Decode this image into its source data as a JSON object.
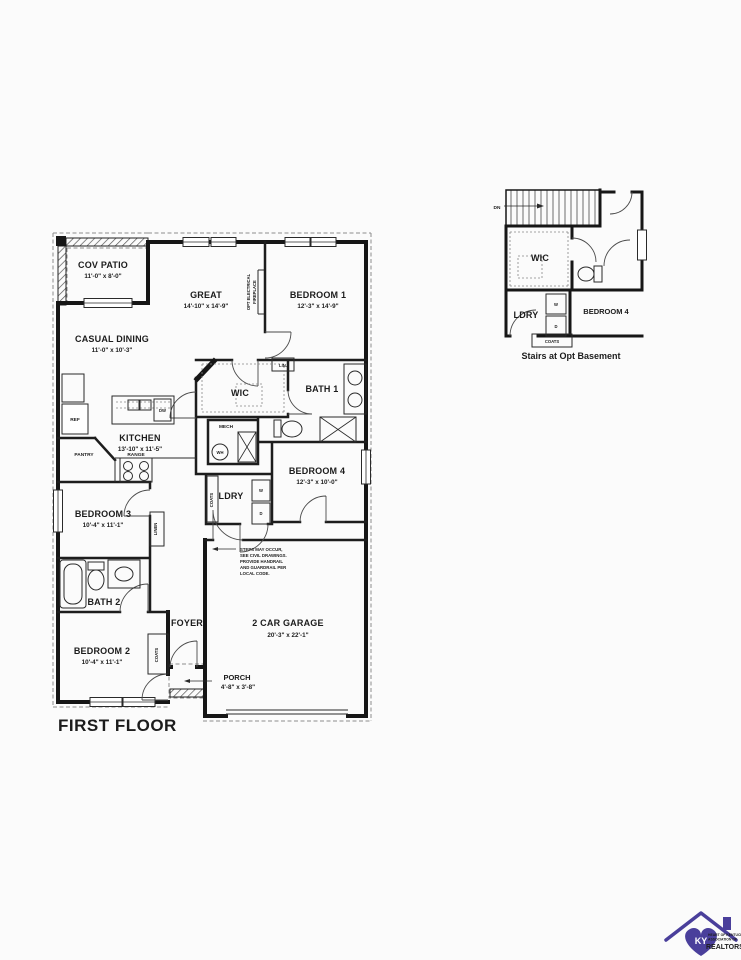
{
  "title": "FIRST FLOOR",
  "rooms": {
    "cov_patio": {
      "name": "COV PATIO",
      "dims": "11'-0\" x 8'-0\""
    },
    "casual_dining": {
      "name": "CASUAL DINING",
      "dims": "11'-0\" x 10'-3\""
    },
    "great": {
      "name": "GREAT",
      "dims": "14'-10\" x 14'-9\""
    },
    "bedroom1": {
      "name": "BEDROOM 1",
      "dims": "12'-3\" x 14'-9\""
    },
    "wic": {
      "name": "WIC"
    },
    "bath1": {
      "name": "BATH 1"
    },
    "kitchen": {
      "name": "KITCHEN",
      "dims": "13'-10\" x 11'-5\""
    },
    "bedroom4": {
      "name": "BEDROOM 4",
      "dims": "12'-3\" x 10'-0\""
    },
    "bedroom3": {
      "name": "BEDROOM 3",
      "dims": "10'-4\" x 11'-1\""
    },
    "ldry": {
      "name": "LDRY"
    },
    "bath2": {
      "name": "BATH 2"
    },
    "foyer": {
      "name": "FOYER"
    },
    "garage": {
      "name": "2 CAR GARAGE",
      "dims": "20'-3\" x 22'-1\""
    },
    "bedroom2": {
      "name": "BEDROOM 2",
      "dims": "10'-4\" x 11'-1\""
    },
    "porch": {
      "name": "PORCH",
      "dims": "4'-8\" x 3'-8\""
    }
  },
  "fixtures": {
    "ref": "REF",
    "pantry": "PANTRY",
    "range": "RANGE",
    "dw": "DW",
    "mech": "MECH",
    "wh": "WH",
    "lin": "LIN.",
    "linen": "LINEN",
    "coats": "COATS",
    "washer": "W",
    "dryer": "D"
  },
  "annotations": {
    "fireplace_line1": "OPT ELECTRICAL",
    "fireplace_line2": "FIREPLACE",
    "steps_note": [
      "STEPS MAY OCCUR,",
      "SEE CIVIL DRAWINGS.",
      "PROVIDE HANDRAIL",
      "AND GUARDRAIL PER",
      "LOCAL CODE."
    ]
  },
  "inset": {
    "caption": "Stairs at Opt Basement",
    "dn": "DN",
    "wic": "WIC",
    "ldry": "LDRY",
    "bedroom4": "BEDROOM 4",
    "coats": "COATS",
    "washer": "W",
    "dryer": "D"
  },
  "logo": {
    "monogram": "KY",
    "line1": "HEART OF KENTUCKY",
    "line2": "ASSOCIATION OF",
    "line3": "REALTORS®",
    "color": "#4a3f9b"
  }
}
